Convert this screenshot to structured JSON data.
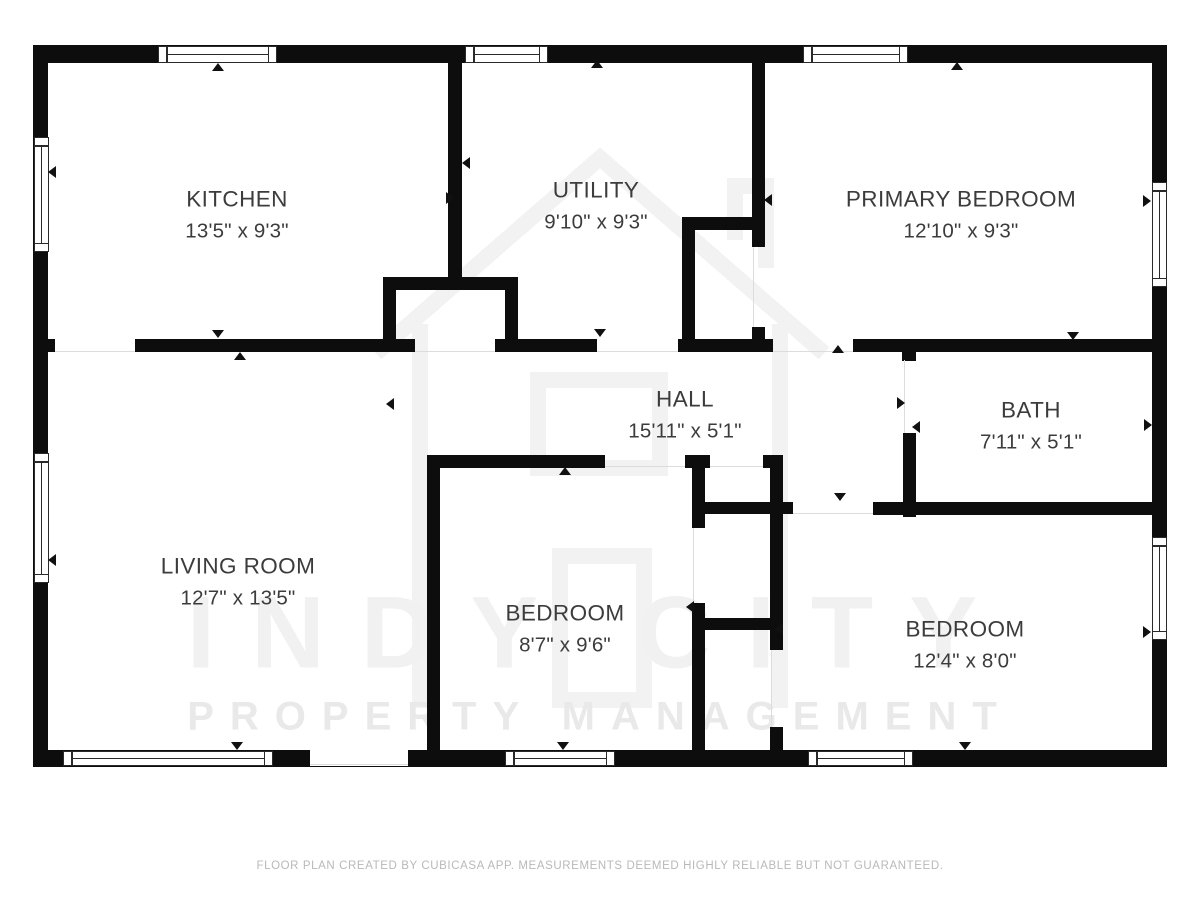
{
  "footer": {
    "text": "FLOOR PLAN CREATED BY CUBICASA APP. MEASUREMENTS DEEMED HIGHLY RELIABLE BUT NOT GUARANTEED."
  },
  "watermark": {
    "line1": "INDY CITY",
    "line2": "PROPERTY MANAGEMENT"
  },
  "colors": {
    "wall": "#0d0d0d",
    "label_text": "#3c3c3c",
    "footer_text": "#b9b9b9",
    "watermark": "#f0f0f0",
    "threshold": "#dcdcdc",
    "background": "#ffffff"
  },
  "rooms": [
    {
      "key": "kitchen",
      "name": "KITCHEN",
      "dims": "13'5\" x 9'3\"",
      "x": 237,
      "y": 215
    },
    {
      "key": "utility",
      "name": "UTILITY",
      "dims": "9'10\" x 9'3\"",
      "x": 596,
      "y": 206
    },
    {
      "key": "primary-bedroom",
      "name": "PRIMARY BEDROOM",
      "dims": "12'10\" x 9'3\"",
      "x": 961,
      "y": 215
    },
    {
      "key": "hall",
      "name": "HALL",
      "dims": "15'11\" x 5'1\"",
      "x": 685,
      "y": 415
    },
    {
      "key": "bath",
      "name": "BATH",
      "dims": "7'11\" x 5'1\"",
      "x": 1031,
      "y": 426
    },
    {
      "key": "living-room",
      "name": "LIVING ROOM",
      "dims": "12'7\" x 13'5\"",
      "x": 238,
      "y": 582
    },
    {
      "key": "bedroom-small",
      "name": "BEDROOM",
      "dims": "8'7\" x 9'6\"",
      "x": 565,
      "y": 629
    },
    {
      "key": "bedroom-large",
      "name": "BEDROOM",
      "dims": "12'4\" x 8'0\"",
      "x": 965,
      "y": 645
    }
  ],
  "plan": {
    "walls": [
      [
        33,
        45,
        1134,
        18
      ],
      [
        33,
        45,
        15,
        722
      ],
      [
        1152,
        45,
        15,
        722
      ],
      [
        33,
        750,
        1134,
        17
      ],
      [
        448,
        63,
        14,
        215
      ],
      [
        752,
        63,
        13,
        184
      ],
      [
        752,
        327,
        13,
        12
      ],
      [
        383,
        277,
        135,
        13
      ],
      [
        383,
        277,
        13,
        75
      ],
      [
        505,
        277,
        13,
        75
      ],
      [
        48,
        339,
        7,
        13
      ],
      [
        135,
        339,
        280,
        13
      ],
      [
        495,
        339,
        102,
        13
      ],
      [
        678,
        339,
        95,
        13
      ],
      [
        853,
        339,
        299,
        13
      ],
      [
        682,
        217,
        83,
        13
      ],
      [
        682,
        217,
        13,
        135
      ],
      [
        902,
        352,
        14,
        9
      ],
      [
        903,
        433,
        13,
        84
      ],
      [
        703,
        502,
        90,
        12
      ],
      [
        873,
        502,
        279,
        13
      ],
      [
        427,
        455,
        178,
        13
      ],
      [
        685,
        455,
        25,
        13
      ],
      [
        763,
        455,
        20,
        13
      ],
      [
        427,
        455,
        13,
        295
      ],
      [
        692,
        455,
        13,
        73
      ],
      [
        692,
        603,
        13,
        147
      ],
      [
        770,
        455,
        13,
        47
      ],
      [
        770,
        502,
        13,
        148
      ],
      [
        770,
        727,
        13,
        23
      ],
      [
        692,
        618,
        91,
        12
      ]
    ],
    "entry_gap": {
      "x": 310,
      "y": 750,
      "w": 98,
      "h": 16
    },
    "windows": [
      {
        "x": 158,
        "y": 46,
        "w": 119,
        "h": 17,
        "o": "h"
      },
      {
        "x": 465,
        "y": 46,
        "w": 83,
        "h": 17,
        "o": "h"
      },
      {
        "x": 803,
        "y": 46,
        "w": 105,
        "h": 17,
        "o": "h"
      },
      {
        "x": 34,
        "y": 137,
        "w": 15,
        "h": 115,
        "o": "v"
      },
      {
        "x": 34,
        "y": 453,
        "w": 15,
        "h": 130,
        "o": "v"
      },
      {
        "x": 1152,
        "y": 182,
        "w": 15,
        "h": 105,
        "o": "v"
      },
      {
        "x": 1152,
        "y": 537,
        "w": 15,
        "h": 103,
        "o": "v"
      },
      {
        "x": 63,
        "y": 751,
        "w": 210,
        "h": 15,
        "o": "h"
      },
      {
        "x": 505,
        "y": 751,
        "w": 110,
        "h": 15,
        "o": "h"
      },
      {
        "x": 808,
        "y": 751,
        "w": 105,
        "h": 15,
        "o": "h"
      }
    ],
    "thresholds": [
      [
        55,
        351,
        80,
        1
      ],
      [
        415,
        351,
        80,
        1
      ],
      [
        597,
        351,
        81,
        1
      ],
      [
        773,
        351,
        80,
        1
      ],
      [
        904,
        360,
        1,
        73
      ],
      [
        605,
        466,
        80,
        1
      ],
      [
        710,
        466,
        53,
        1
      ],
      [
        793,
        513,
        80,
        1
      ],
      [
        693,
        528,
        1,
        75
      ],
      [
        771,
        650,
        1,
        77
      ],
      [
        310,
        764,
        98,
        1
      ],
      [
        753,
        247,
        1,
        80
      ]
    ],
    "arrows": [
      {
        "d": "up",
        "x": 218,
        "y": 67
      },
      {
        "d": "up",
        "x": 597,
        "y": 64
      },
      {
        "d": "up",
        "x": 957,
        "y": 66
      },
      {
        "d": "down",
        "x": 218,
        "y": 334
      },
      {
        "d": "up",
        "x": 240,
        "y": 356
      },
      {
        "d": "down",
        "x": 600,
        "y": 333
      },
      {
        "d": "up",
        "x": 838,
        "y": 349
      },
      {
        "d": "down",
        "x": 1073,
        "y": 336
      },
      {
        "d": "left",
        "x": 466,
        "y": 163
      },
      {
        "d": "right",
        "x": 450,
        "y": 198
      },
      {
        "d": "left",
        "x": 768,
        "y": 200
      },
      {
        "d": "left",
        "x": 52,
        "y": 172
      },
      {
        "d": "left",
        "x": 52,
        "y": 560
      },
      {
        "d": "left",
        "x": 390,
        "y": 404
      },
      {
        "d": "right",
        "x": 901,
        "y": 403
      },
      {
        "d": "left",
        "x": 916,
        "y": 427
      },
      {
        "d": "right",
        "x": 1147,
        "y": 201
      },
      {
        "d": "right",
        "x": 1148,
        "y": 425
      },
      {
        "d": "right",
        "x": 1147,
        "y": 632
      },
      {
        "d": "up",
        "x": 565,
        "y": 471
      },
      {
        "d": "left",
        "x": 690,
        "y": 607
      },
      {
        "d": "left",
        "x": 779,
        "y": 629
      },
      {
        "d": "down",
        "x": 840,
        "y": 497
      },
      {
        "d": "down",
        "x": 237,
        "y": 746
      },
      {
        "d": "down",
        "x": 563,
        "y": 746
      },
      {
        "d": "down",
        "x": 965,
        "y": 746
      }
    ]
  }
}
